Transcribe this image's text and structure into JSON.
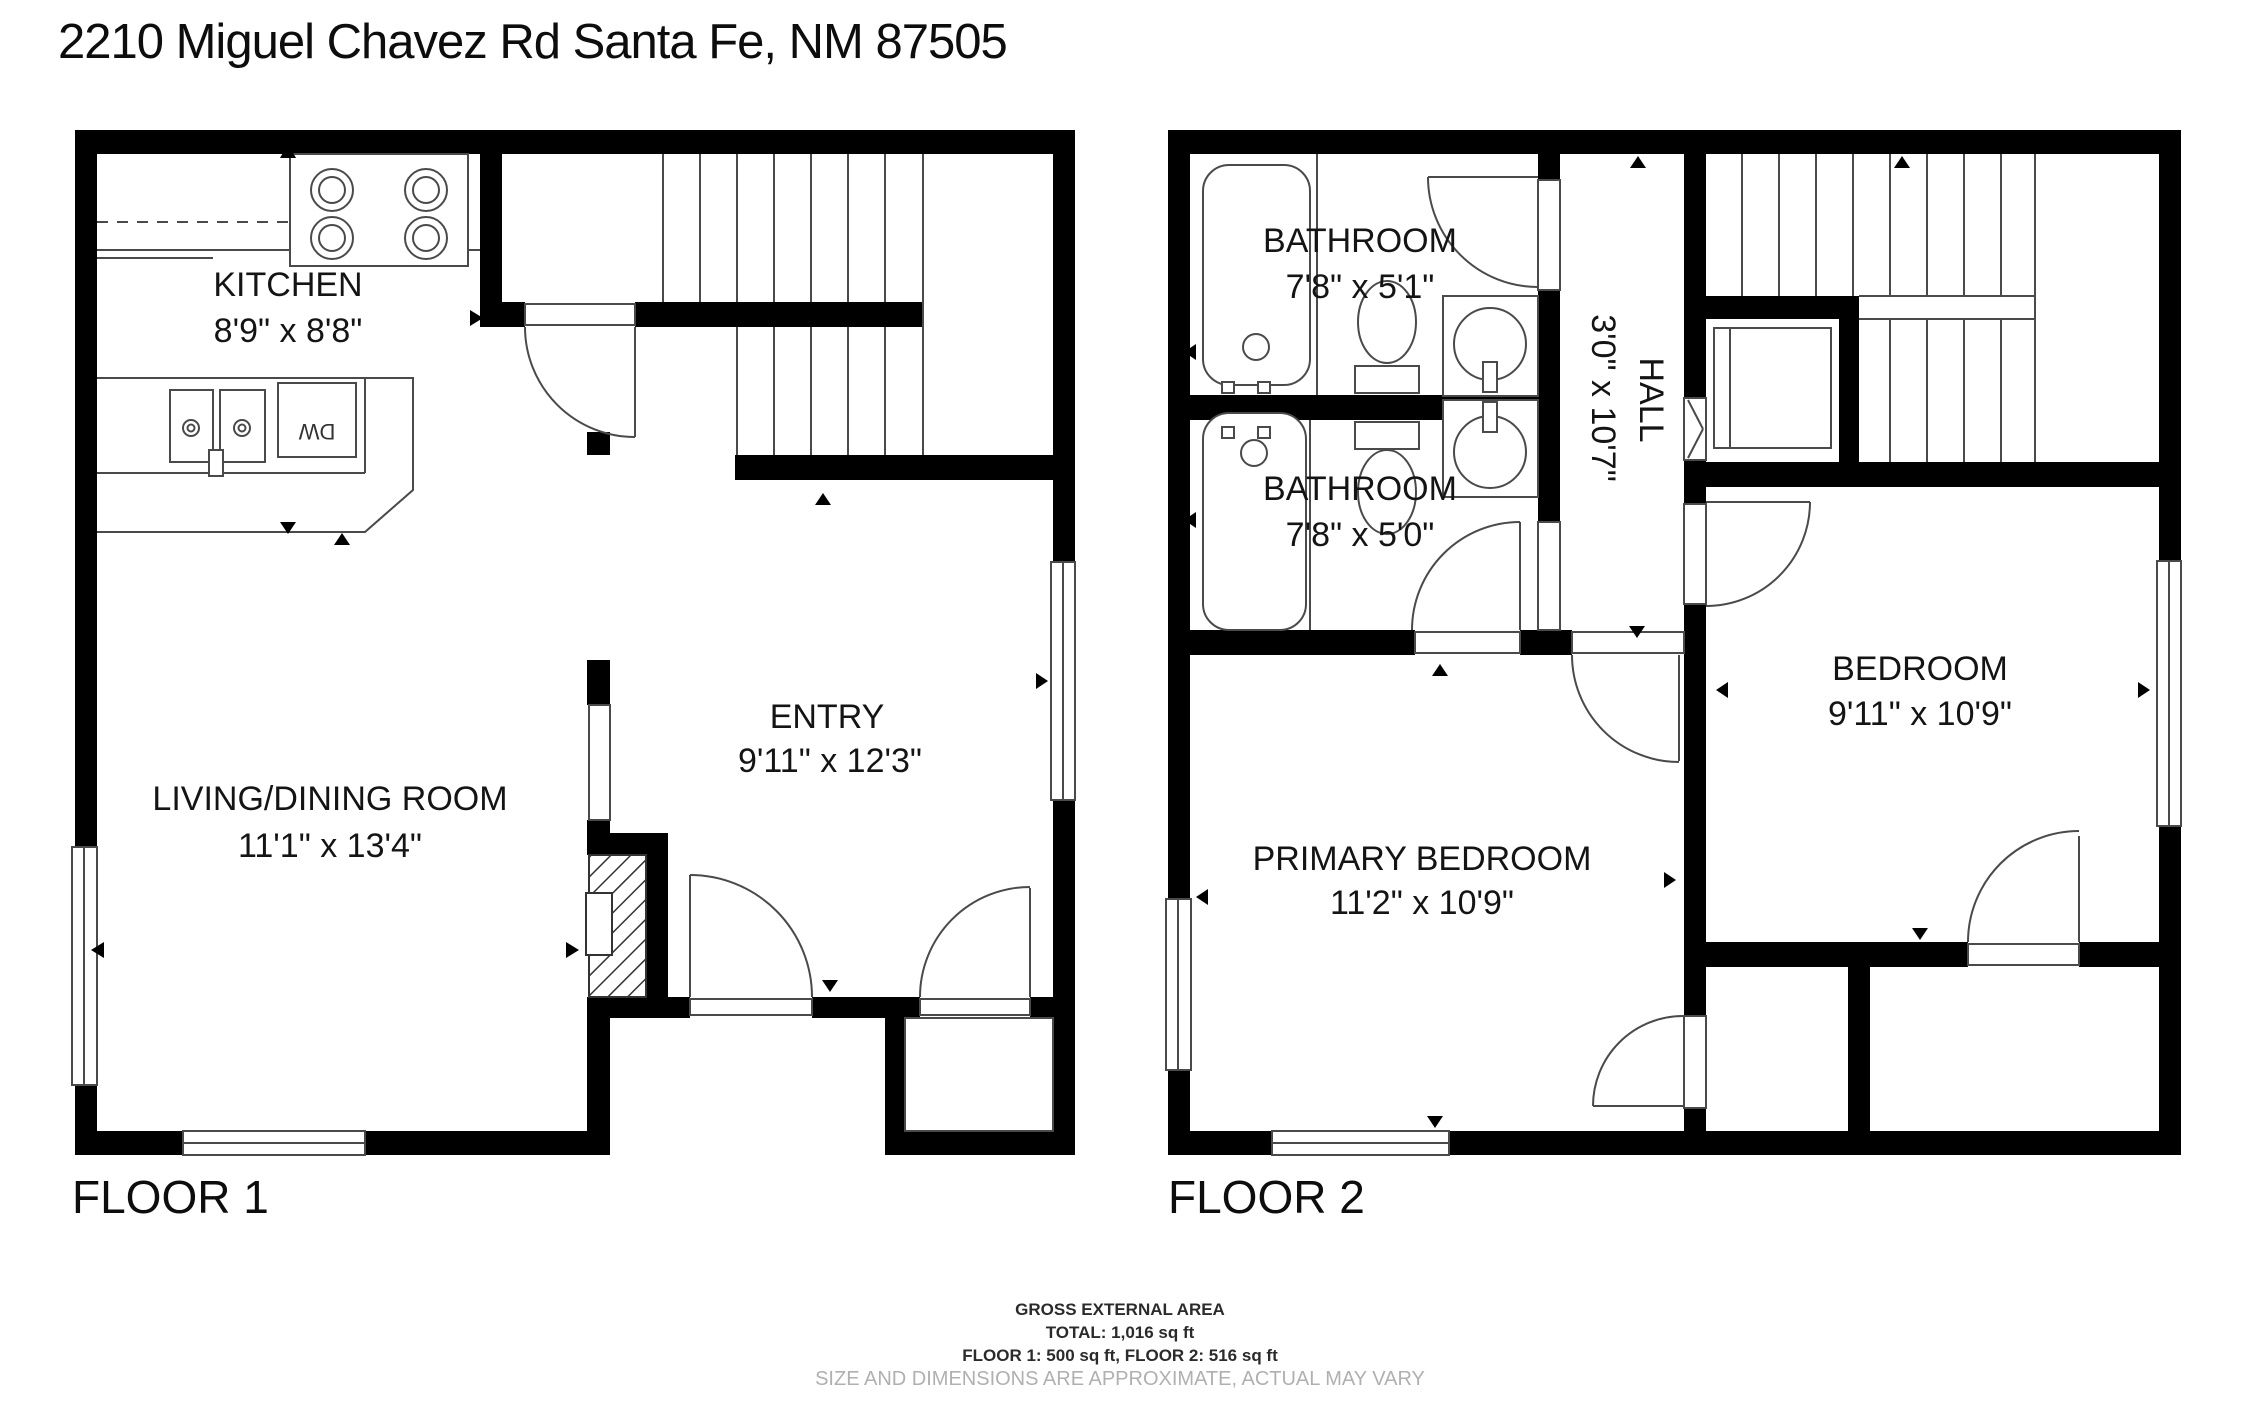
{
  "title": "2210 Miguel Chavez Rd Santa Fe, NM 87505",
  "floor1": {
    "label": "FLOOR 1",
    "kitchen": {
      "name": "KITCHEN",
      "dims": "8'9\" x 8'8\""
    },
    "living": {
      "name": "LIVING/DINING ROOM",
      "dims": "11'1\" x 13'4\""
    },
    "entry": {
      "name": "ENTRY",
      "dims": "9'11\" x 12'3\""
    },
    "dishwasher": "DW"
  },
  "floor2": {
    "label": "FLOOR 2",
    "bathroom1": {
      "name": "BATHROOM",
      "dims": "7'8\" x 5'1\""
    },
    "bathroom2": {
      "name": "BATHROOM",
      "dims": "7'8\" x 5'0\""
    },
    "hall": {
      "name": "HALL",
      "dims": "3'0\" x 10'7\""
    },
    "primary": {
      "name": "PRIMARY BEDROOM",
      "dims": "11'2\" x 10'9\""
    },
    "bedroom": {
      "name": "BEDROOM",
      "dims": "9'11\" x 10'9\""
    }
  },
  "footer": {
    "line1": "GROSS EXTERNAL AREA",
    "line2": "TOTAL: 1,016 sq ft",
    "line3": "FLOOR 1: 500 sq ft, FLOOR 2: 516 sq ft",
    "line4": "SIZE AND DIMENSIONS ARE APPROXIMATE, ACTUAL MAY VARY"
  },
  "colors": {
    "wall": "#000000",
    "line": "#4a4a4a",
    "muted": "#b0b0b0"
  }
}
